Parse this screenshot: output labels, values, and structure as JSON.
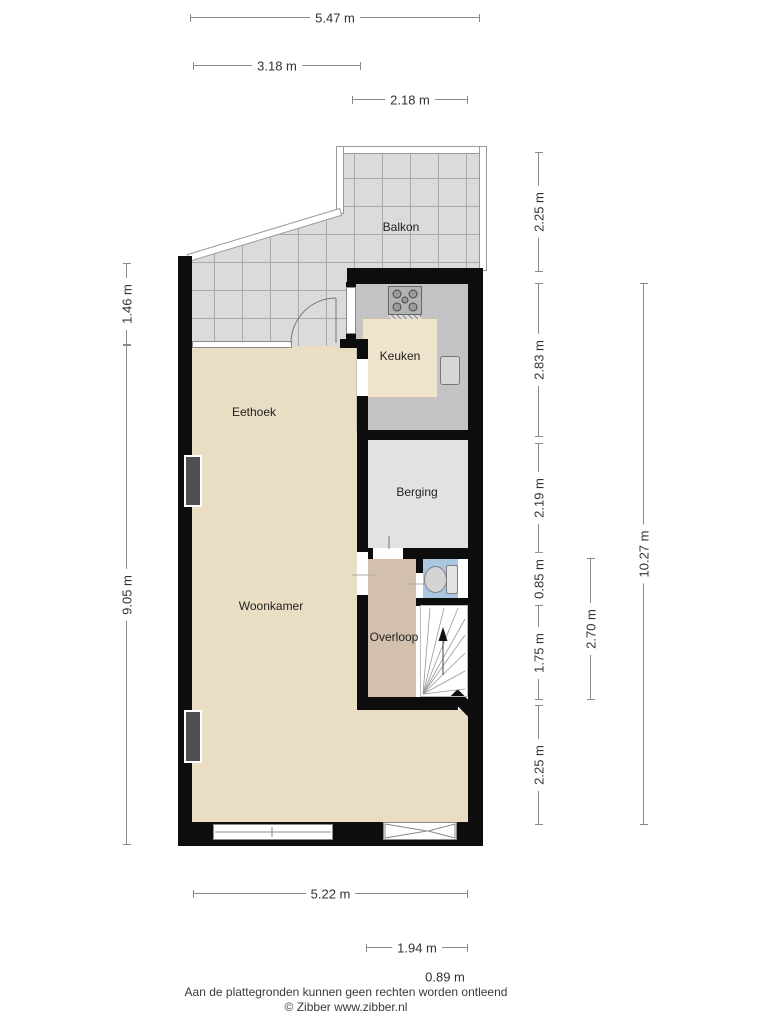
{
  "rooms": {
    "balkon": {
      "label": "Balkon"
    },
    "keuken": {
      "label": "Keuken"
    },
    "eethoek": {
      "label": "Eethoek"
    },
    "berging": {
      "label": "Berging"
    },
    "woonkamer": {
      "label": "Woonkamer"
    },
    "overloop": {
      "label": "Overloop"
    }
  },
  "dimensions": {
    "top": [
      {
        "label": "5.47 m"
      },
      {
        "label": "3.18 m"
      },
      {
        "label": "2.18 m"
      }
    ],
    "left": [
      {
        "label": "1.46 m"
      },
      {
        "label": "9.05 m"
      }
    ],
    "right": [
      {
        "label": "2.25 m"
      },
      {
        "label": "2.83 m"
      },
      {
        "label": "2.19 m"
      },
      {
        "label": "0.85 m"
      },
      {
        "label": "1.75 m"
      },
      {
        "label": "2.25 m"
      },
      {
        "label": "2.70 m"
      },
      {
        "label": "10.27 m"
      }
    ],
    "bottom": [
      {
        "label": "5.22 m"
      },
      {
        "label": "1.94 m"
      },
      {
        "label": "0.89 m"
      }
    ]
  },
  "footer": {
    "disclaimer": "Aan de plattegronden kunnen geen rechten worden ontleend",
    "credit": "© Zibber www.zibber.nl"
  },
  "icons": {
    "stairs_arrow": "up-arrow",
    "toilet": "toilet",
    "stove": "gas-hob"
  },
  "colors": {
    "wall": "#0d0d0d",
    "balcony_tile": "#dbdbdb",
    "living_floor": "#e9ddc4",
    "kitchen_floor": "#c3c3c5",
    "counter": "#efe3cb",
    "storage_floor": "#e2e2e2",
    "hall_floor": "#d2c0ad",
    "toilet_floor": "#aac6e1",
    "dimension_line": "#8a8a8a",
    "text": "#333333"
  }
}
